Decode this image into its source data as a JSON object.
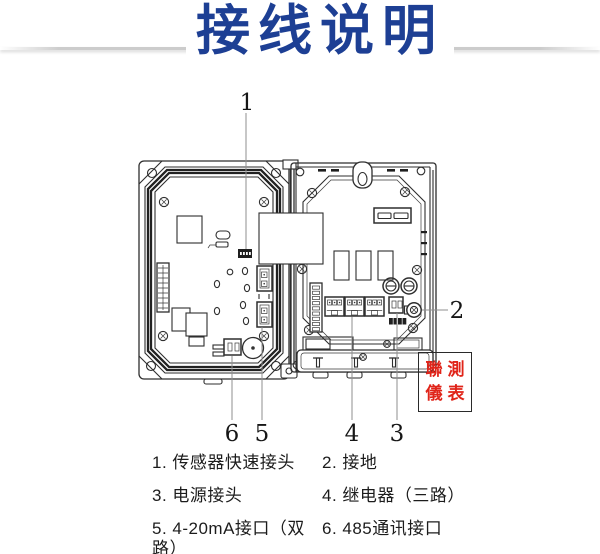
{
  "page": {
    "title": "接线说明",
    "title_color": "#1d3f94",
    "background": "#ffffff"
  },
  "watermark": {
    "line1": "聯測",
    "line2": "儀表",
    "text_color": "#e02419"
  },
  "callouts": {
    "n1": "1",
    "n2": "2",
    "n3": "3",
    "n4": "4",
    "n5": "5",
    "n6": "6"
  },
  "legend": {
    "items": [
      {
        "text": "1. 传感器快速接头"
      },
      {
        "text": "2. 接地"
      },
      {
        "text": "3. 电源接头"
      },
      {
        "text": "4. 继电器（三路）"
      },
      {
        "text": "5. 4-20mA接口（双路）"
      },
      {
        "text": "6. 485通讯接口"
      }
    ]
  }
}
